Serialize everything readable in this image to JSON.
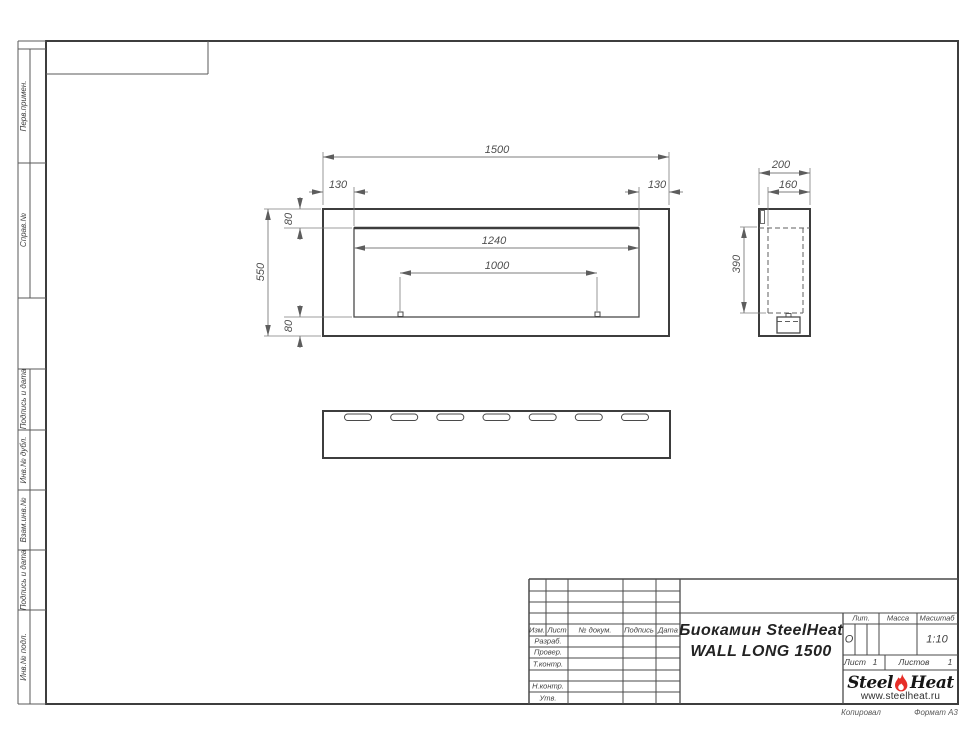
{
  "sheet": {
    "copy_note": "Копировал",
    "format_note": "Формат А3"
  },
  "margin_labels": [
    "Перв.примен.",
    "Справ.№",
    "Подпись и дата",
    "Инв.№ дубл.",
    "Взам.инв.№",
    "Подпись и дата",
    "Инв.№ подл."
  ],
  "dimensions": {
    "front": {
      "total_width": "1500",
      "offset_left": "130",
      "offset_right": "130",
      "top_gap": "80",
      "total_height": "550",
      "bottom_gap": "80",
      "opening_width": "1240",
      "burner_length": "1000"
    },
    "side": {
      "depth": "200",
      "inner_depth": "160",
      "inner_height": "390"
    }
  },
  "title_block": {
    "revision_header": {
      "izm": "Изм.",
      "list": "Лист",
      "doc_no": "№ докум.",
      "signature": "Подпись",
      "date": "Дата"
    },
    "role_rows": [
      "Разраб.",
      "Провер.",
      "Т.контр.",
      "Н.контр.",
      "Утв."
    ],
    "product_name_line1": "Биокамин SteelHeat",
    "product_name_line2": "WALL LONG 1500",
    "lit_label": "Лит.",
    "lit_value": "О",
    "mass_label": "Масса",
    "mass_value": "",
    "scale_label": "Масштаб",
    "scale_value": "1:10",
    "sheet_label": "Лист",
    "sheet_number": "1",
    "sheets_label": "Листов",
    "sheets_total": "1",
    "logo": {
      "word1": "Steel",
      "word2": "Heat",
      "website": "www.steelheat.ru"
    }
  },
  "colors": {
    "line_main": "#3d3d3d",
    "line_thin": "#5a5a5a",
    "line_dim": "#7d7d7d",
    "text": "#3f3f3f",
    "flame_red": "#e62e28"
  }
}
